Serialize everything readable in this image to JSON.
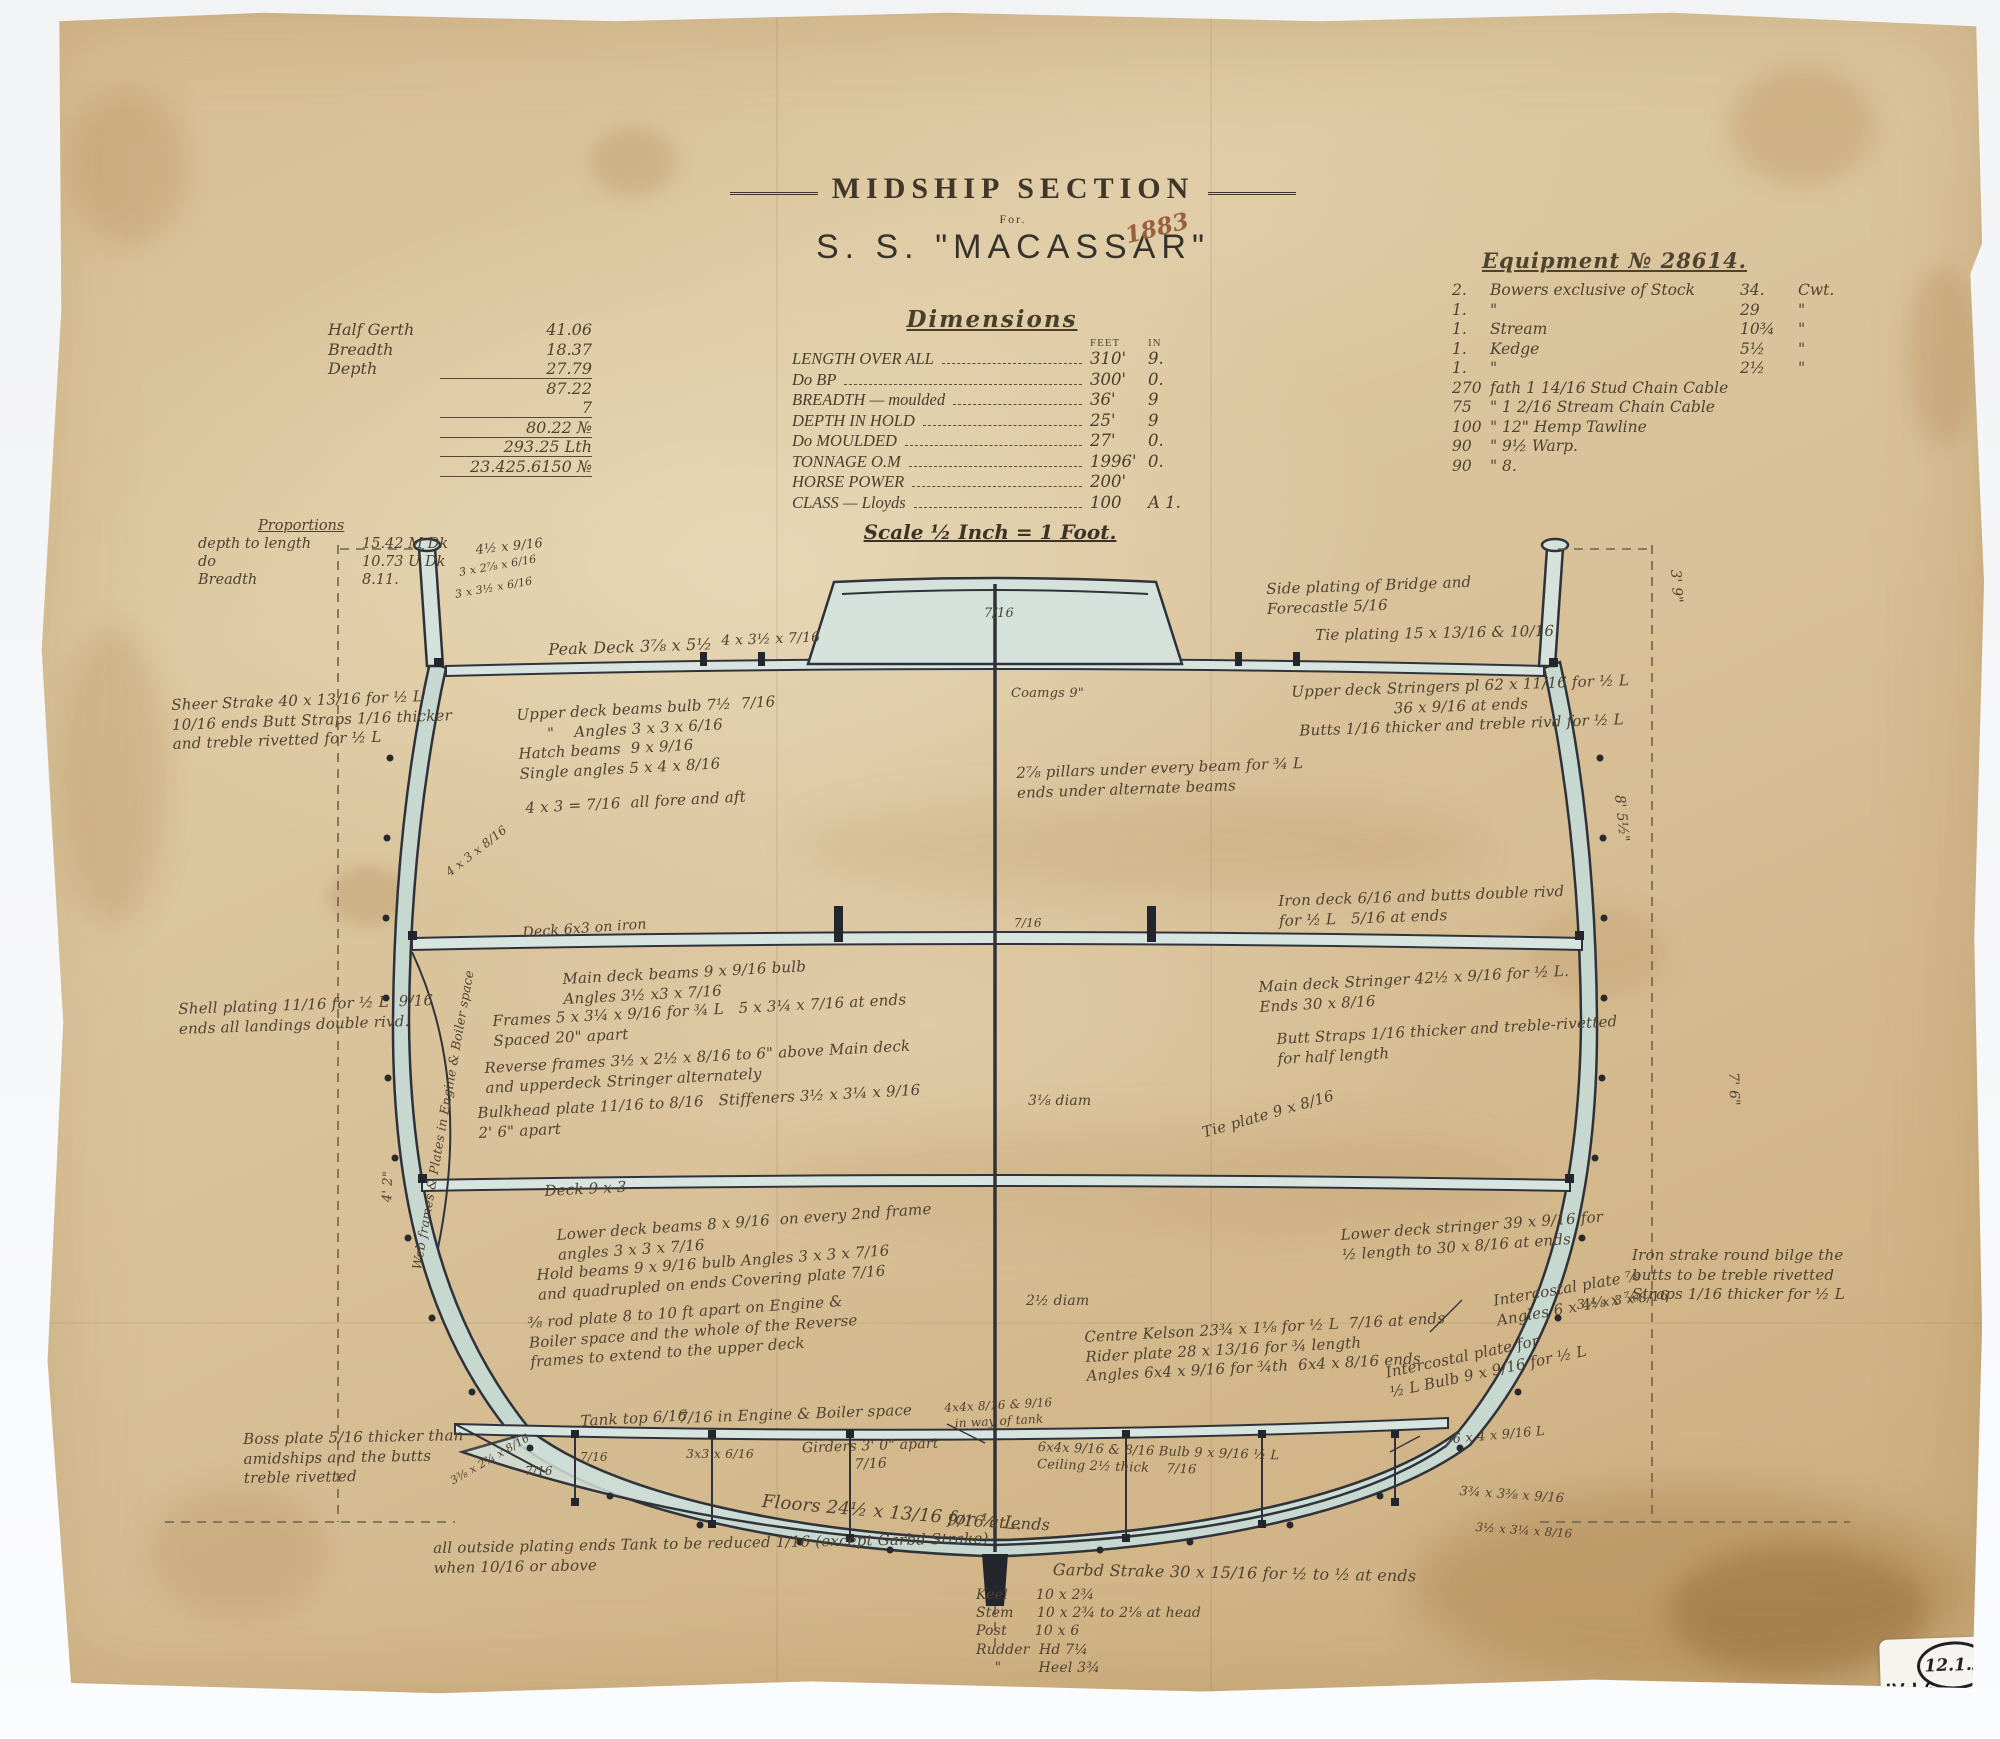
{
  "title_block": {
    "title": "MIDSHIP SECTION",
    "for_label": "For.",
    "ship_name": "S. S. \"MACASSAR\""
  },
  "scale_note": "Scale ½ Inch = 1 Foot.",
  "dimensions": {
    "title": "Dimensions",
    "feet_label": "FEET",
    "in_label": "IN",
    "rows": [
      {
        "label": "LENGTH OVER ALL",
        "feet": "310'",
        "inches": "9."
      },
      {
        "label": "Do   BP",
        "feet": "300'",
        "inches": "0."
      },
      {
        "label": "BREADTH — moulded",
        "feet": "36'",
        "inches": "9"
      },
      {
        "label": "DEPTH IN HOLD",
        "feet": "25'",
        "inches": "9"
      },
      {
        "label": "Do  MOULDED",
        "feet": "27'",
        "inches": "0."
      },
      {
        "label": "TONNAGE O.M",
        "feet": "1996'",
        "inches": "0."
      },
      {
        "label": "HORSE POWER",
        "feet": "200'",
        "inches": ""
      },
      {
        "label": "CLASS — Lloyds",
        "feet": "100",
        "inches": "A 1."
      }
    ]
  },
  "calc_block": {
    "rows": [
      {
        "label": "Half Gerth",
        "value": "41.06"
      },
      {
        "label": "Breadth",
        "value": "18.37"
      },
      {
        "label": "Depth",
        "value": "27.79",
        "u": 1
      },
      {
        "label": "",
        "value": "87.22"
      },
      {
        "label": "",
        "value": "7",
        "u": 1
      },
      {
        "label": "",
        "value": "80.22 №",
        "u": 1
      },
      {
        "label": "",
        "value": "293.25 Lth",
        "u": 1
      },
      {
        "label": "",
        "value": "23.425.6150 №",
        "u": 1
      }
    ]
  },
  "equipment": {
    "title": "Equipment № 28614.",
    "rows": [
      {
        "c1": "2.",
        "c2": "Bowers exclusive of Stock",
        "c3": "34.",
        "c4": "Cwt."
      },
      {
        "c1": "1.",
        "c2": "\"",
        "c3": "29",
        "c4": "\""
      },
      {
        "c1": "1.",
        "c2": "Stream",
        "c3": "10¾",
        "c4": "\""
      },
      {
        "c1": "1.",
        "c2": "Kedge",
        "c3": "5½",
        "c4": "\""
      },
      {
        "c1": "1.",
        "c2": "\"",
        "c3": "2½",
        "c4": "\""
      },
      {
        "c1": "270",
        "c2": "fath 1 14/16 Stud Chain Cable",
        "c3": "",
        "c4": ""
      },
      {
        "c1": "75",
        "c2": "\"   1 2/16 Stream Chain Cable",
        "c3": "",
        "c4": ""
      },
      {
        "c1": "100",
        "c2": "\"   12\" Hemp Tawline",
        "c3": "",
        "c4": ""
      },
      {
        "c1": "90",
        "c2": "\"   9½ Warp.",
        "c3": "",
        "c4": ""
      },
      {
        "c1": "90",
        "c2": "\"   8.",
        "c3": "",
        "c4": ""
      }
    ]
  },
  "proportions": {
    "title": "Proportions",
    "rows": [
      {
        "label": "depth to length",
        "value": "15.42  M Dk"
      },
      {
        "label": "do",
        "value": "10.73  U Dk"
      },
      {
        "label": "Breadth",
        "value": "8.11."
      }
    ]
  },
  "stamps": {
    "circle_number": "12.1.2",
    "shelf_roman": "IV",
    "shelf_rest": "L6",
    "small_number": "2"
  },
  "annotations": [
    {
      "t": "1883",
      "x": 1094,
      "y": 216,
      "r": -14,
      "cl": "red"
    },
    {
      "t": "Sheer Strake 40 x 13/16 for ½ L\n10/16 ends Butt Straps 1/16 thicker\nand treble rivetted for ½ L",
      "x": 143,
      "y": 690,
      "w": 310,
      "r": -2
    },
    {
      "t": "Shell plating 11/16 for ½ L  9/16\nends all landings double rivd.",
      "x": 150,
      "y": 994,
      "w": 300,
      "r": -2
    },
    {
      "t": "Boss plate 5/16 thicker than\namidships and the butts\ntreble rivetted",
      "x": 215,
      "y": 1424,
      "w": 260,
      "r": -1
    },
    {
      "t": "all outside plating ends Tank to be reduced 1/16 (except Garbd Strake)\nwhen 10/16 or above",
      "x": 405,
      "y": 1533,
      "w": 560,
      "r": -1
    },
    {
      "t": "4½ x 9/16",
      "x": 447,
      "y": 537,
      "s": 13,
      "r": -6
    },
    {
      "t": "3 x 2⅞ x 6/16",
      "x": 430,
      "y": 560,
      "s": 11,
      "r": -10
    },
    {
      "t": "3 x 3½ x 6/16",
      "x": 426,
      "y": 582,
      "s": 11,
      "r": -10
    },
    {
      "t": "Peak Deck 3⅞ x 5½",
      "x": 520,
      "y": 634,
      "s": 16,
      "r": -2
    },
    {
      "t": "4 x 3½ x 7/16",
      "x": 693,
      "y": 626,
      "s": 14,
      "r": -2
    },
    {
      "t": "7/16",
      "x": 956,
      "y": 600,
      "s": 13
    },
    {
      "t": "Coamgs 9\"",
      "x": 983,
      "y": 680,
      "s": 13
    },
    {
      "t": "Side plating of Bridge and\nForecastle 5/16",
      "x": 1238,
      "y": 574,
      "w": 300,
      "r": -2
    },
    {
      "t": "Tie plating 15 x 13/16 & 10/16",
      "x": 1287,
      "y": 620,
      "r": -1
    },
    {
      "t": "3' 9\"",
      "x": 1656,
      "y": 563,
      "s": 14,
      "r": 86
    },
    {
      "t": "Upper deck beams bulb 7½  7/16\n      \"    Angles 3 x 3 x 6/16\nHatch beams  9 x 9/16\nSingle angles 5 x 4 x 8/16",
      "x": 488,
      "y": 700,
      "w": 340,
      "r": -3
    },
    {
      "t": "4 x 3 = 7/16  all fore and aft",
      "x": 497,
      "y": 793,
      "r": -3
    },
    {
      "t": "4 x 3 x 8/16",
      "x": 415,
      "y": 862,
      "s": 12,
      "r": -38
    },
    {
      "t": "2⅞ pillars under every beam for ¾ L\nends under alternate beams",
      "x": 988,
      "y": 758,
      "w": 340,
      "r": -2
    },
    {
      "t": "Upper deck Stringers pl 62 x 11/16 for ½ L\n36 x 9/16 at ends\nButts 1/16 thicker and treble rivd for ½ L",
      "x": 1232,
      "y": 678,
      "w": 400,
      "r": -2,
      "a": "center"
    },
    {
      "t": "Iron deck 6/16 and butts double rivd\nfor ½ L   5/16 at ends",
      "x": 1250,
      "y": 886,
      "w": 380,
      "r": -2
    },
    {
      "t": "8' 5½\"",
      "x": 1600,
      "y": 788,
      "s": 14,
      "r": 84
    },
    {
      "t": "Deck 6x3 on iron",
      "x": 494,
      "y": 918,
      "s": 14,
      "r": -4
    },
    {
      "t": "7/16",
      "x": 986,
      "y": 910,
      "s": 12
    },
    {
      "t": "Main deck beams 9 x 9/16 bulb\nAngles 3½ x3 x 7/16",
      "x": 534,
      "y": 964,
      "w": 320,
      "r": -3
    },
    {
      "t": "Frames 5 x 3¼ x 9/16 for ¾ L   5 x 3¼ x 7/16 at ends\nSpaced 20\" apart",
      "x": 464,
      "y": 1006,
      "w": 450,
      "r": -3
    },
    {
      "t": "Reverse frames 3½ x 2½ x 8/16 to 6\" above Main deck\nand upperdeck Stringer alternately",
      "x": 456,
      "y": 1053,
      "w": 460,
      "r": -3
    },
    {
      "t": "Bulkhead plate 11/16 to 8/16   Stiffeners 3½ x 3¼ x 9/16\n2' 6\" apart",
      "x": 449,
      "y": 1098,
      "w": 450,
      "r": -3
    },
    {
      "t": "Main deck Stringer 42½ x 9/16 for ½ L.\nEnds 30 x 8/16",
      "x": 1230,
      "y": 972,
      "w": 380,
      "r": -3
    },
    {
      "t": "Butt Straps 1/16 thicker and treble-rivetted\nfor half length",
      "x": 1248,
      "y": 1024,
      "w": 370,
      "r": -3
    },
    {
      "t": "3⅛ diam",
      "x": 1000,
      "y": 1086,
      "s": 14
    },
    {
      "t": "Tie plate 9 x 8/16",
      "x": 1172,
      "y": 1118,
      "r": -16
    },
    {
      "t": "Deck 9 x 3",
      "x": 516,
      "y": 1176,
      "s": 15,
      "r": -3
    },
    {
      "t": "Web frames & Plates in Engine & Boiler space",
      "x": 381,
      "y": 1262,
      "s": 12.5,
      "r": -80
    },
    {
      "t": "4' 2\"",
      "x": 352,
      "y": 1196,
      "s": 13,
      "r": -88
    },
    {
      "t": "Lower deck beams 8 x 9/16  on every 2nd frame\nangles 3 x 3 x 7/16",
      "x": 528,
      "y": 1220,
      "w": 390,
      "r": -4
    },
    {
      "t": "Hold beams 9 x 9/16 bulb Angles 3 x 3 x 7/16\nand quadrupled on ends Covering plate 7/16",
      "x": 508,
      "y": 1260,
      "w": 430,
      "r": -4
    },
    {
      "t": "⅜ rod plate 8 to 10 ft apart on Engine &\nBoiler space and the whole of the Reverse\nframes to extend to the upper deck",
      "x": 499,
      "y": 1308,
      "w": 390,
      "r": -4
    },
    {
      "t": "Lower deck stringer 39 x 9/16 for\n½ length to 30 x 8/16 at ends",
      "x": 1312,
      "y": 1220,
      "w": 340,
      "r": -4
    },
    {
      "t": "2½ diam",
      "x": 998,
      "y": 1286,
      "s": 14
    },
    {
      "t": "Centre Kelson 23¾ x 1⅛ for ½ L  7/16 at ends\nRider plate 28 x 13/16 for ¾ length\nAngles 6x4 x 9/16 for ¾th  6x4 x 8/16 ends",
      "x": 1056,
      "y": 1322,
      "w": 430,
      "r": -3
    },
    {
      "t": "Intercostal plate ⅞\nAngles 6 x 4⅛ x ⅞",
      "x": 1464,
      "y": 1286,
      "w": 240,
      "r": -10
    },
    {
      "t": "Intercostal plate for\n½ L Bulb 9 x 9/16 for ½ L",
      "x": 1356,
      "y": 1358,
      "w": 260,
      "r": -12
    },
    {
      "t": "Iron strake round bilge the\nbutts to be treble rivetted\nStraps 1/16 thicker for ½ L",
      "x": 1604,
      "y": 1240,
      "w": 250
    },
    {
      "t": "3½ x 3 x 8/16",
      "x": 1548,
      "y": 1292,
      "s": 13,
      "r": -6
    },
    {
      "t": "Tank top 6/16",
      "x": 552,
      "y": 1406,
      "s": 15,
      "r": -3
    },
    {
      "t": "7/16 in Engine & Boiler space",
      "x": 650,
      "y": 1403,
      "s": 15,
      "r": -2
    },
    {
      "t": "3x3 x 6/16",
      "x": 658,
      "y": 1440,
      "s": 12.5
    },
    {
      "t": "Girders 3' 0\" apart\n7/16",
      "x": 757,
      "y": 1434,
      "w": 170,
      "s": 14,
      "a": "center",
      "r": -2
    },
    {
      "t": "4x4x 8/16 & 9/16\nin way of tank",
      "x": 895,
      "y": 1396,
      "w": 150,
      "s": 12,
      "a": "center",
      "r": -3
    },
    {
      "t": "Floors 24½ x 13/16 for ½ L.",
      "x": 735,
      "y": 1484,
      "s": 18,
      "r": 5
    },
    {
      "t": "9/16 at ends",
      "x": 920,
      "y": 1504,
      "s": 16,
      "r": 3
    },
    {
      "t": "6x4x 9/16 & 8/16 Bulb 9 x 9/16 ½ L\nCeiling 2½ thick    7/16",
      "x": 1010,
      "y": 1434,
      "w": 320,
      "s": 13,
      "r": 2
    },
    {
      "t": "6 x 4 x 9/16 L",
      "x": 1424,
      "y": 1426,
      "s": 13,
      "r": -5
    },
    {
      "t": "3¾ x 3⅜ x 9/16",
      "x": 1432,
      "y": 1478,
      "s": 13,
      "r": 4
    },
    {
      "t": "3½ x 3¼ x 8/16",
      "x": 1448,
      "y": 1514,
      "s": 12,
      "r": 4
    },
    {
      "t": "7/16",
      "x": 497,
      "y": 1458,
      "s": 12
    },
    {
      "t": "7/16",
      "x": 552,
      "y": 1444,
      "s": 12
    },
    {
      "t": "3⅜ x 2¾ x 8/16",
      "x": 420,
      "y": 1470,
      "s": 11,
      "r": -30
    },
    {
      "t": "Garbd Strake 30 x 15/16 for ½ to ½ at ends",
      "x": 1025,
      "y": 1554,
      "s": 16,
      "r": 1
    },
    {
      "t": "Keel      10 x 2¾\nStem     10 x 2¾ to 2⅛ at head\nPost      10 x 6\nRudder  Hd 7¼\n    \"        Heel 3¾",
      "x": 948,
      "y": 1580,
      "w": 330,
      "s": 14
    },
    {
      "t": "7' 6\"",
      "x": 1714,
      "y": 1066,
      "s": 14,
      "r": 88
    }
  ]
}
